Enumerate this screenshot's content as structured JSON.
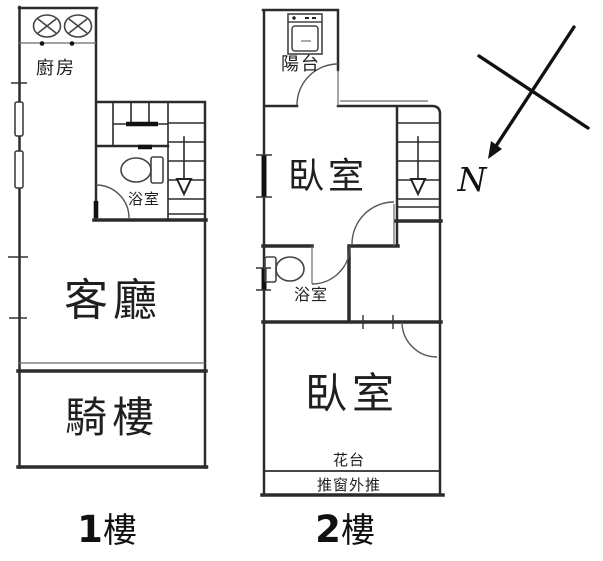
{
  "colors": {
    "background": "#ffffff",
    "wall_line": "#2b2b2b",
    "text": "#1f1f1f"
  },
  "floor1": {
    "caption": {
      "number": "1",
      "suffix": "樓"
    },
    "labels": {
      "kitchen": "廚房",
      "bathroom": "浴室",
      "living": "客廳",
      "arcade": "騎樓"
    },
    "icons": [
      "gas-stove-icon",
      "toilet-icon",
      "stair-down-arrow-icon",
      "door-swing-icon",
      "window-icon"
    ]
  },
  "floor2": {
    "caption": {
      "number": "2",
      "suffix": "樓"
    },
    "labels": {
      "balcony": "陽台",
      "bedroom_top": "臥室",
      "bathroom": "浴室",
      "bedroom_bottom": "臥室",
      "flower_bed": "花台",
      "window_note": "推窗外推"
    },
    "icons": [
      "washing-machine-icon",
      "toilet-icon",
      "stair-down-arrow-icon",
      "door-swing-icon",
      "window-icon"
    ]
  },
  "compass": {
    "north_label": "N",
    "icon": "north-arrow-icon"
  }
}
